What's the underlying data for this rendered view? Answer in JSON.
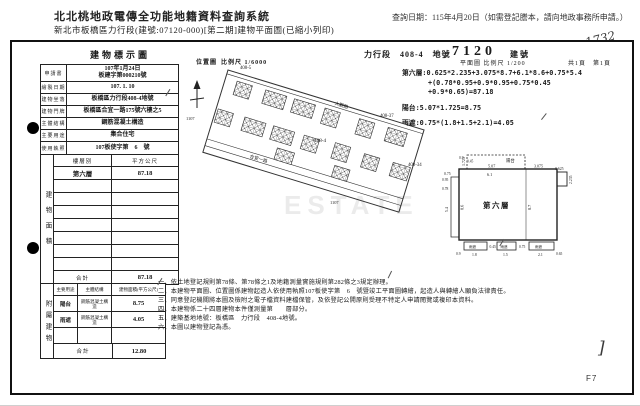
{
  "system_header": {
    "title": "北北桃地政電傳全功能地籍資料查詢系統",
    "query_date": "查詢日期：115年4月20日（如需登記謄本，請向地政事務所申請。）",
    "subtitle": "新北市板橋區力行段(建號:07120-000)[第二期]建物平面圖(已縮小列印)"
  },
  "doc_header": {
    "doc_title": "建物標示圖",
    "land_section": "力行段　408-4　地號",
    "building_no": "7120",
    "building_no_label": "建號",
    "handwritten_no": "1732"
  },
  "info_table": {
    "rows": [
      {
        "label": "申請書",
        "value": "107年1月24日\n板建字第000210號"
      },
      {
        "label": "繪製日期",
        "value": "107. 1. 10"
      },
      {
        "label": "建物坐落",
        "value": "板橋區力行段408-4地號"
      },
      {
        "label": "建物門牌",
        "value": "板橋區合宜一路175號六樓之5"
      },
      {
        "label": "主體結構",
        "value": "鋼筋混凝土構造"
      },
      {
        "label": "主要用途",
        "value": "集合住宅"
      },
      {
        "label": "使用執照",
        "value": "107板使字第　6　號"
      }
    ]
  },
  "floor_area_table": {
    "section_label": "建物面積",
    "headers": [
      "樓層別",
      "平方公尺"
    ],
    "rows": [
      {
        "floor": "第六層",
        "area": "87.18"
      }
    ],
    "empty_rows": 7,
    "total_label": "合計",
    "total": "87.18"
  },
  "annex_table": {
    "section_label": "附屬建物",
    "headers": [
      "主要用途",
      "主體結構",
      "建物面積(平方公尺)"
    ],
    "rows": [
      {
        "use": "陽台",
        "structure": "鋼筋混凝土構造",
        "area": "8.75"
      },
      {
        "use": "雨遮",
        "structure": "鋼筋混凝土構造",
        "area": "4.05"
      },
      {
        "use": "",
        "structure": "",
        "area": ""
      }
    ],
    "total_label": "合計",
    "total": "12.80"
  },
  "notes": [
    "一、依土地登記規則第78條、第78條之1及地籍測量實施規則第282條之3規定辦理。",
    "二、本建物平面圖、位置圖係建物起造人依使用執照107板使字第　6　號暨竣工平面圖轉繪，起造人與轉繪人願負法律責任。",
    "三、同意登記機關將本圖及檢附之電子檔資料建檔保管，及依登記公開原則受理不特定人申請閱覽或複印本資料。",
    "四、本建物係二十四層建物本件僅測量第　　層部分。",
    "五、建築基地地號：板橋區　力行段　408-4地號。",
    "六、本圖以建物登記為憑。"
  ],
  "location_map": {
    "label": "位置圖",
    "scale": "比例尺 1/6000",
    "parcel_label_main": "408-4",
    "parcel_label_nw": "408-5",
    "parcel_label_ne": "408-37",
    "parcel_label_e": "408-34",
    "lot_1107_a": "1107",
    "lot_1107_b": "1107",
    "lot_1107_c": "1107",
    "road_top": "大觀路",
    "road_bottom": "合宜一路"
  },
  "calc_block": {
    "label": "平面圖",
    "scale": "比例尺 1/200",
    "pages": "共1頁　第1頁",
    "lines": [
      "第六層:0.625*2.235+3.075*8.7+6.1*8.6+0.75*5.4",
      "+(0.78*0.95+0.9*0.95+0.75*0.45",
      "+0.9*0.65)=87.18",
      "陽台:5.07*1.725=8.75",
      "雨遮:0.75*(1.8+1.5+2.1)=4.05"
    ]
  },
  "floor_plan": {
    "room_label": "第六層",
    "balcony_label": "陽台",
    "canopy_label": "雨遮",
    "dims": {
      "balcony_w": "5.07",
      "balcony_h": "1.725",
      "main_w": "6.1",
      "main_h": "8.6",
      "right_w": "3.075",
      "right_h": "8.7",
      "east_w": "0.625",
      "east_h": "2.235",
      "west_w": "0.75",
      "west_h": "5.4",
      "c1_w": "1.8",
      "c2_w": "1.5",
      "c3_w": "2.1",
      "d_09": "0.9",
      "d_045": "0.45",
      "d_078": "0.78",
      "d_095": "0.95",
      "d_065": "0.65",
      "d_075": "0.75"
    }
  },
  "watermark": "ESTATE",
  "footer": {
    "page_code": "F7",
    "handwritten_bracket": "]"
  }
}
